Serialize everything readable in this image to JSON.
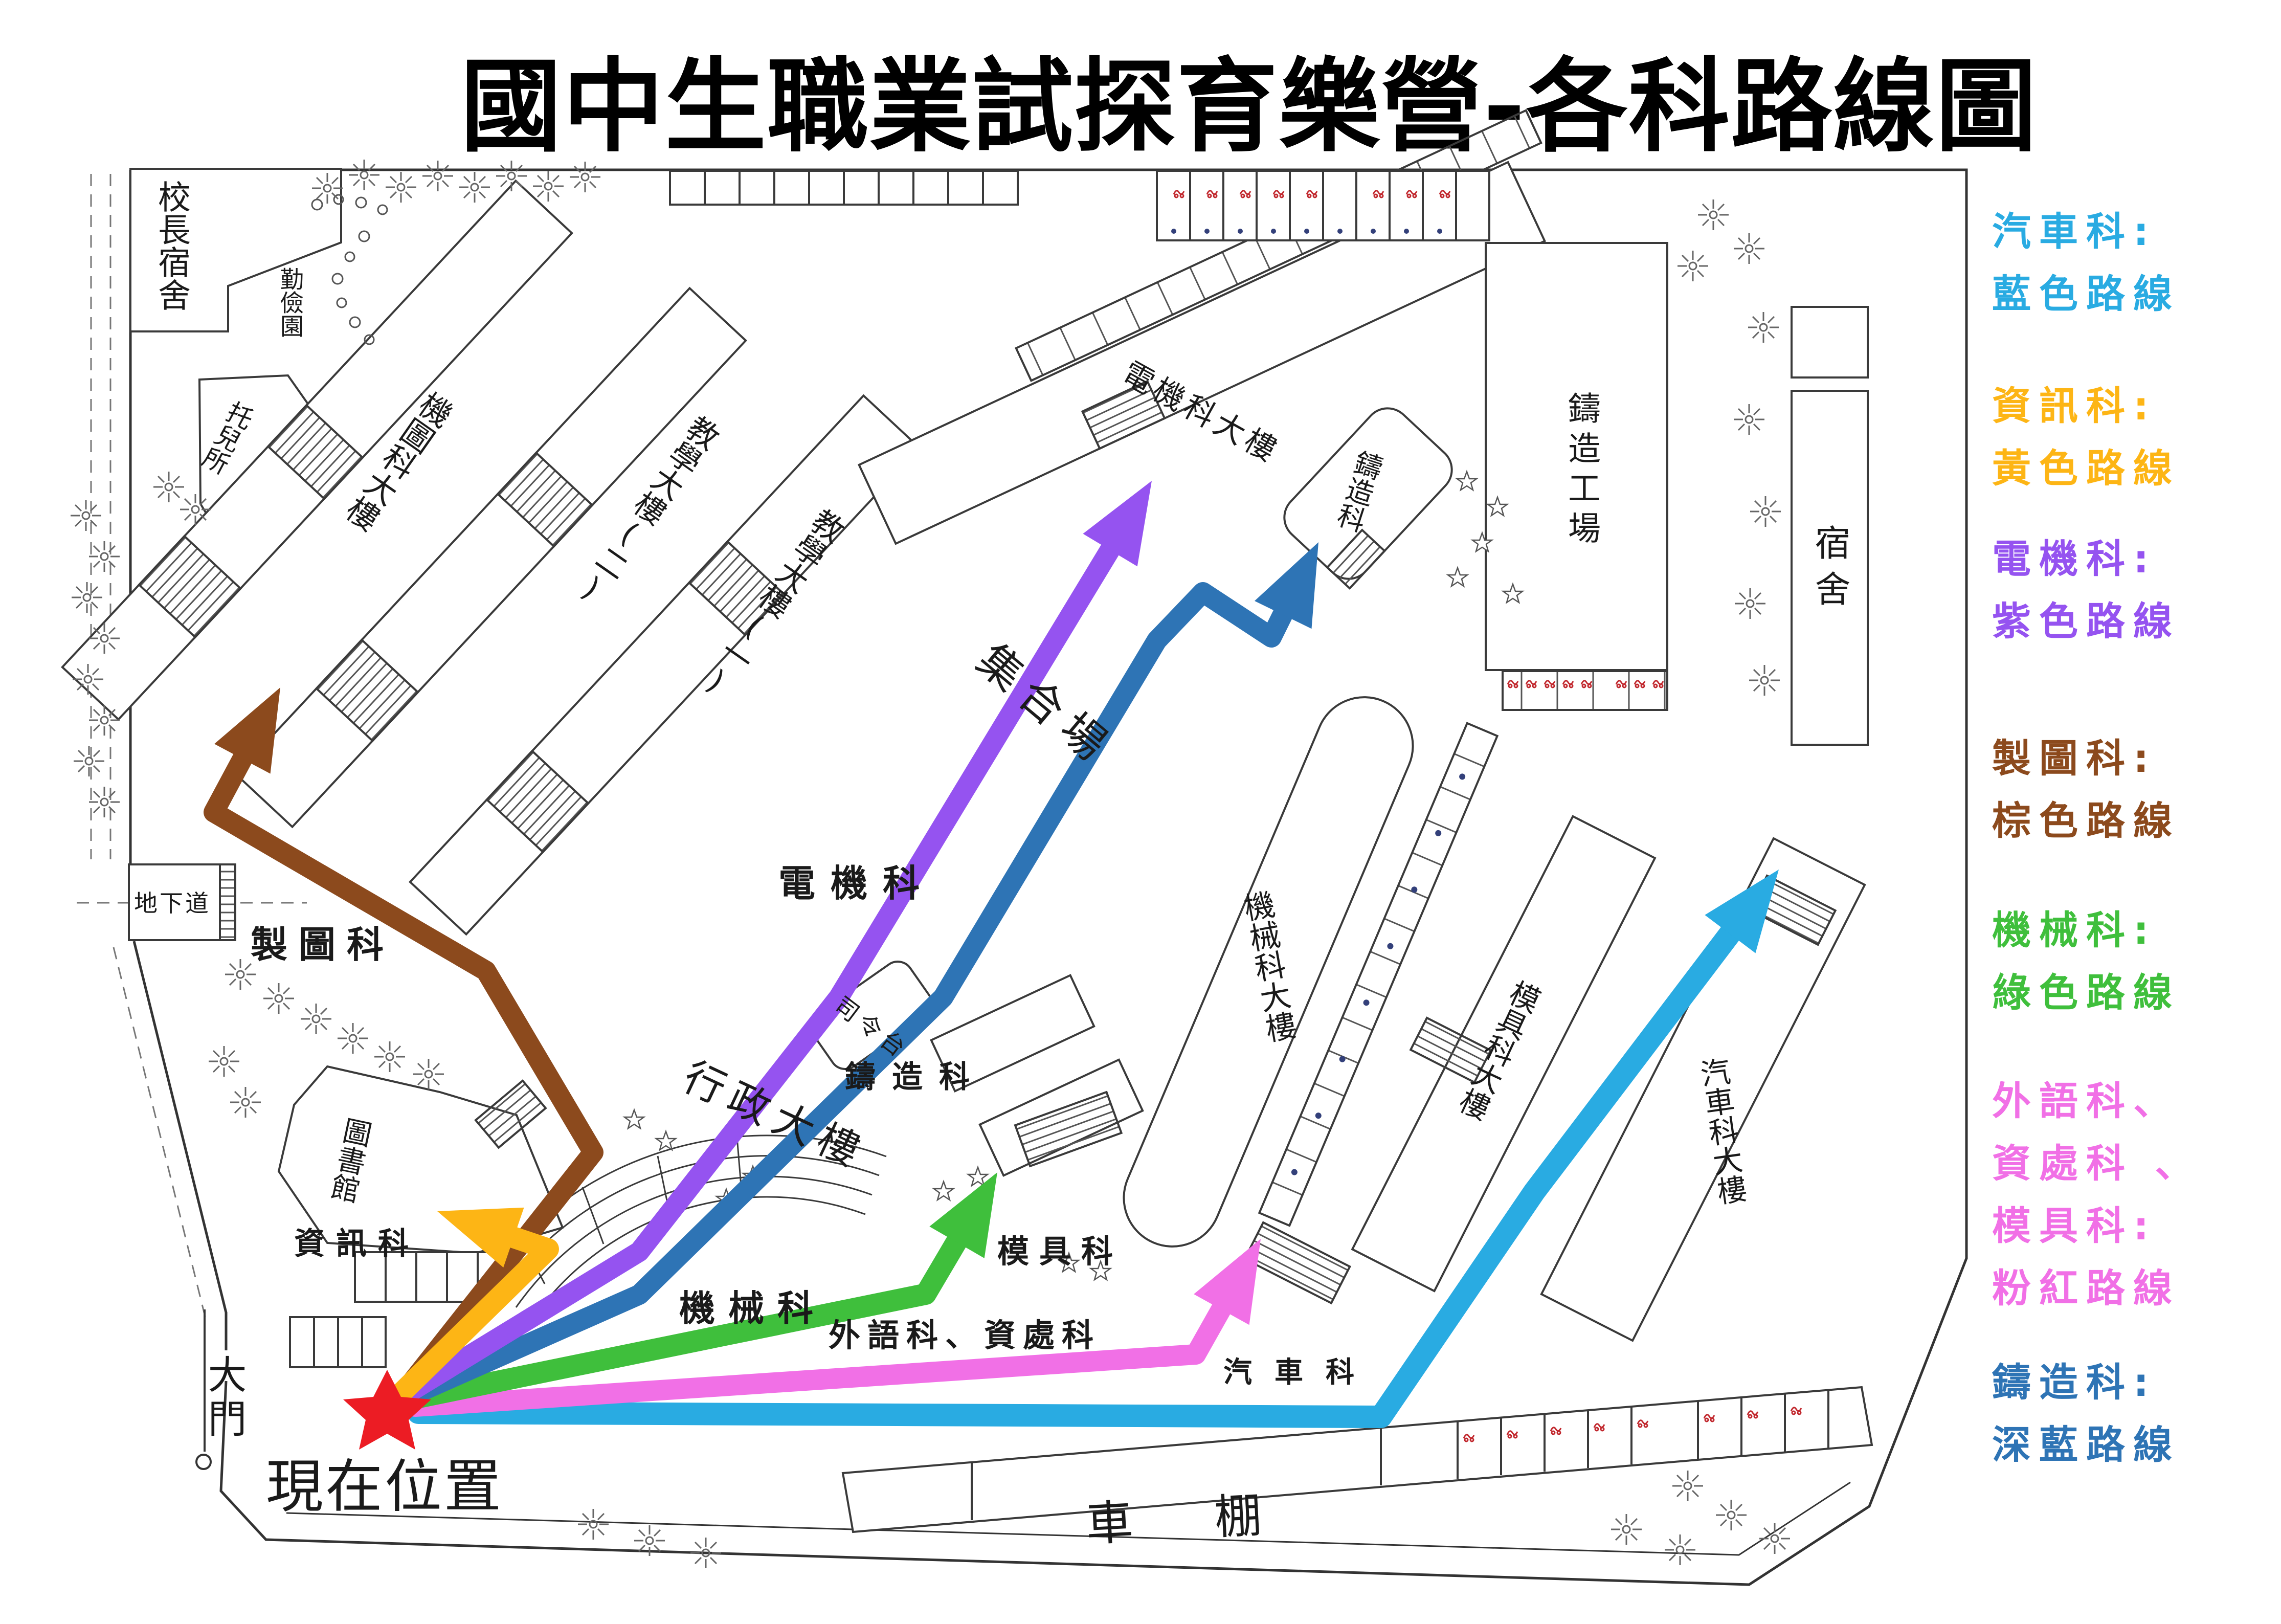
{
  "title": "國中生職業試探育樂營-各科路線圖",
  "current_location": {
    "star_color": "#EC1C24",
    "label": "現在位置"
  },
  "legend": {
    "entries": [
      {
        "color": "#29ABE2",
        "lines": [
          "汽車科:",
          "藍色路線"
        ]
      },
      {
        "color": "#FDB515",
        "lines": [
          "資訊科:",
          "黃色路線"
        ]
      },
      {
        "color": "#9553F0",
        "lines": [
          "電機科:",
          "紫色路線"
        ]
      },
      {
        "color": "#8C4A1D",
        "lines": [
          "製圖科:",
          "棕色路線"
        ]
      },
      {
        "color": "#3FBF3C",
        "lines": [
          "機械科:",
          "綠色路線"
        ]
      },
      {
        "color": "#F170E6",
        "lines": [
          "外語科、",
          "資處科 、",
          "模具科:",
          "粉紅路線"
        ]
      },
      {
        "color": "#2E74B5",
        "lines": [
          "鑄造科:",
          "深藍路線"
        ]
      }
    ]
  },
  "routes": {
    "auto": {
      "color": "#29ABE2",
      "label": "汽車科"
    },
    "info": {
      "color": "#FDB515",
      "label": "資訊科"
    },
    "electric": {
      "color": "#9553F0",
      "label": "電機科"
    },
    "drafting": {
      "color": "#8C4A1D",
      "label": "製圖科"
    },
    "machine": {
      "color": "#3FBF3C",
      "label": "機械科"
    },
    "pink": {
      "color": "#F170E6",
      "label_main": "外語科、資處科",
      "label_mold": "模具科"
    },
    "casting": {
      "color": "#2E74B5",
      "label": "鑄造科"
    }
  },
  "map": {
    "labels": {
      "principal_dorm": "校長宿舍",
      "qinjian_garden": "勤儉園",
      "nursery": "托兒所",
      "drafting_bldg": "機圖科大樓",
      "teaching2": "教學大樓(二)",
      "teaching1": "教學大樓(一)",
      "electric_bldg": "電機科大樓",
      "casting_dept": "鑄造科",
      "casting_workshop": "鑄造工場",
      "dormitory": "宿舍",
      "assembly_ground": "集合場",
      "stage": "司令台",
      "machine_bldg": "機械科大樓",
      "mold_bldg": "模具科大樓",
      "auto_bldg": "汽車科大樓",
      "admin_bldg": "行政大樓",
      "library": "圖書館",
      "bike_shed": "車棚",
      "main_gate": "大門",
      "underpass": "地下道"
    }
  }
}
